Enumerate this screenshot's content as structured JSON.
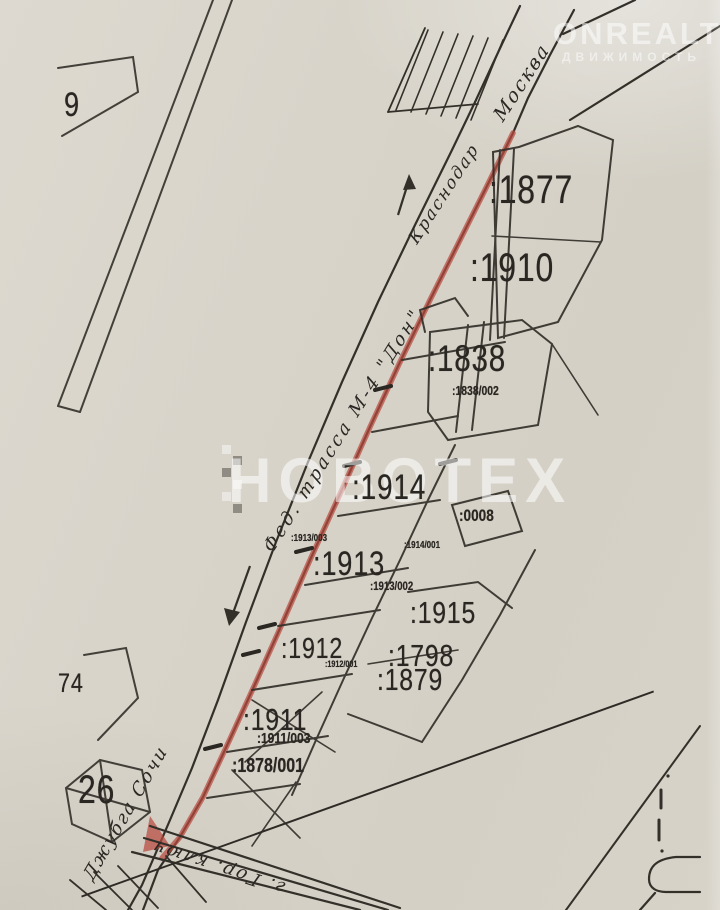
{
  "watermarks": {
    "center": "НОВОТЕХ",
    "brand": "ONREALT",
    "brand_sub": "ДВИЖИМОСТЬ"
  },
  "handwritten": {
    "direction_moscow": "Москва",
    "direction_krasnodar": "Краснодар",
    "highway_label": "Фед. трасса М-4 \"Дон\"",
    "direction_sochi": "Джубга Сочи",
    "bottom_road_label": "г. Гор. ключ"
  },
  "plot_labels": {
    "p9": "9",
    "p74": "74",
    "p26": "26",
    "p1877": ":1877",
    "p1910": ":1910",
    "p1838": ":1838",
    "p1838_002": ":1838/002",
    "p1914": ":1914",
    "p0008": ":0008",
    "p1913": ":1913",
    "p1913_003": ":1913/003",
    "p1914_001": ":1914/001",
    "p1913_002": ":1913/002",
    "p1915": ":1915",
    "p1798": ":1798",
    "p1879": ":1879",
    "p1912": ":1912",
    "p1912_001": ":1912/001",
    "p1911": ":1911",
    "p1911_003": ":1911/003",
    "p1878_001": ":1878/001"
  },
  "colors": {
    "paper": "#d7d3c9",
    "ink": "#2e2b26",
    "road_highlight": "#b84a3e",
    "watermark_white": "rgba(255,255,255,0.55)"
  }
}
